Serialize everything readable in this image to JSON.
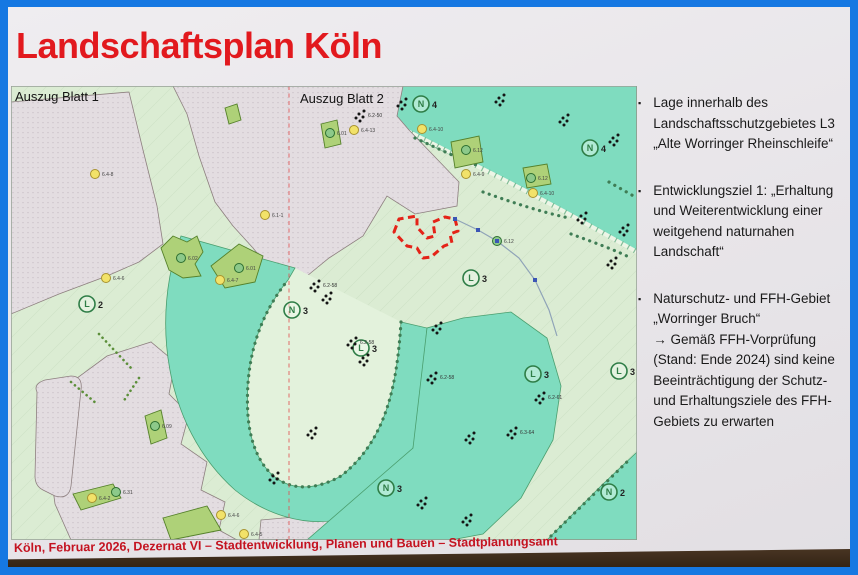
{
  "slide": {
    "title": "Landschaftsplan Köln",
    "footer": "Köln, Februar 2026, Dezernat VI – Stadtentwicklung, Planen und Bauen – Stadtplanungsamt"
  },
  "bullets": [
    {
      "text": "Lage innerhalb des Landschaftsschutzgebietes L3 „Alte Worringer Rheinschleife“"
    },
    {
      "text": "Entwicklungsziel 1: „Erhaltung und Weiterentwicklung einer weitgehend naturnahen Landschaft“"
    },
    {
      "text": "Naturschutz- und FFH-Gebiet „Worringer Bruch“",
      "note": "→ Gemäß FFH-Vorprüfung (Stand: Ende 2024) sind keine Beeinträchtigung der Schutz- und Erhaltungsziele des FFH-Gebiets zu erwarten"
    }
  ],
  "map": {
    "label_blatt1": "Auszug Blatt 1",
    "label_blatt2": "Auszug Blatt 2",
    "colors": {
      "nature_teal": "#7fdcbf",
      "field_green": "#dbecd3",
      "urban_gray": "#e3dde1",
      "measure_green": "#aed178",
      "project_outline_red": "#e42318",
      "divider_red": "#e05555",
      "marker_yellow": "#f2e269"
    },
    "zones": [
      {
        "letter": "N",
        "number": "4",
        "x": 410,
        "y": 18
      },
      {
        "letter": "N",
        "number": "4",
        "x": 579,
        "y": 62
      },
      {
        "letter": "L",
        "number": "2",
        "x": 76,
        "y": 218
      },
      {
        "letter": "N",
        "number": "3",
        "x": 281,
        "y": 224
      },
      {
        "letter": "L",
        "number": "3",
        "x": 460,
        "y": 192
      },
      {
        "letter": "L",
        "number": "3",
        "x": 350,
        "y": 262
      },
      {
        "letter": "L",
        "number": "3",
        "x": 522,
        "y": 288
      },
      {
        "letter": "L",
        "number": "3",
        "x": 608,
        "y": 285
      },
      {
        "letter": "N",
        "number": "3",
        "x": 375,
        "y": 402
      },
      {
        "letter": "N",
        "number": "2",
        "x": 598,
        "y": 406
      }
    ],
    "measures": [
      {
        "code": "6.12",
        "x": 455,
        "y": 64,
        "type": "green"
      },
      {
        "code": "6.12",
        "x": 520,
        "y": 92,
        "type": "green"
      },
      {
        "code": "6.12",
        "x": 486,
        "y": 155,
        "type": "green"
      },
      {
        "code": "6.01",
        "x": 319,
        "y": 47,
        "type": "green"
      },
      {
        "code": "6.02",
        "x": 170,
        "y": 172,
        "type": "green"
      },
      {
        "code": "6.01",
        "x": 228,
        "y": 182,
        "type": "green"
      },
      {
        "code": "6.09",
        "x": 144,
        "y": 340,
        "type": "green"
      },
      {
        "code": "6.31",
        "x": 105,
        "y": 406,
        "type": "green"
      },
      {
        "code": "6.4-8",
        "x": 84,
        "y": 88,
        "type": "yellow"
      },
      {
        "code": "6.4-6",
        "x": 95,
        "y": 192,
        "type": "yellow"
      },
      {
        "code": "6.4-7",
        "x": 209,
        "y": 194,
        "type": "yellow"
      },
      {
        "code": "6.1-1",
        "x": 254,
        "y": 129,
        "type": "yellow"
      },
      {
        "code": "6.4-13",
        "x": 343,
        "y": 44,
        "type": "yellow"
      },
      {
        "code": "6.4-10",
        "x": 411,
        "y": 43,
        "type": "yellow"
      },
      {
        "code": "6.4-9",
        "x": 455,
        "y": 88,
        "type": "yellow"
      },
      {
        "code": "6.4-10",
        "x": 522,
        "y": 107,
        "type": "yellow"
      },
      {
        "code": "6.4-2",
        "x": 81,
        "y": 412,
        "type": "yellow"
      },
      {
        "code": "6.4-6",
        "x": 210,
        "y": 429,
        "type": "yellow"
      },
      {
        "code": "6.4-5",
        "x": 233,
        "y": 448,
        "type": "yellow"
      }
    ],
    "tree_clusters": [
      {
        "x": 303,
        "y": 198,
        "label": "6.2-58"
      },
      {
        "x": 315,
        "y": 210
      },
      {
        "x": 340,
        "y": 255,
        "label": "6.2-58"
      },
      {
        "x": 352,
        "y": 272
      },
      {
        "x": 420,
        "y": 290,
        "label": "6.2-58"
      },
      {
        "x": 300,
        "y": 345
      },
      {
        "x": 262,
        "y": 390
      },
      {
        "x": 410,
        "y": 415
      },
      {
        "x": 455,
        "y": 432
      },
      {
        "x": 500,
        "y": 345,
        "label": "6.3-64"
      },
      {
        "x": 528,
        "y": 310,
        "label": "6.2-61"
      },
      {
        "x": 600,
        "y": 175
      },
      {
        "x": 612,
        "y": 142
      },
      {
        "x": 348,
        "y": 28,
        "label": "6.2-50"
      },
      {
        "x": 390,
        "y": 16
      },
      {
        "x": 488,
        "y": 12
      },
      {
        "x": 552,
        "y": 32
      },
      {
        "x": 602,
        "y": 52
      },
      {
        "x": 570,
        "y": 130
      },
      {
        "x": 458,
        "y": 350
      },
      {
        "x": 425,
        "y": 240
      }
    ],
    "utility_points": [
      [
        444,
        133
      ],
      [
        467,
        144
      ],
      [
        486,
        155
      ],
      [
        524,
        194
      ]
    ]
  }
}
